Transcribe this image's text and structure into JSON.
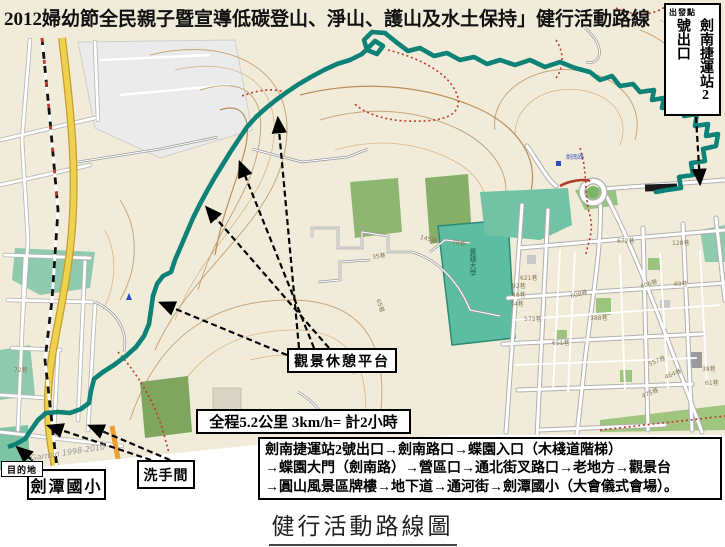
{
  "page": {
    "top_title": "2012婦幼節全民親子暨宣導低碳登山、淨山、護山及水土保持」健行活動路線",
    "bottom_title": "健行活動路線圖"
  },
  "start_box": {
    "tag": "出發點",
    "exit": "2號出口",
    "station": "劍南捷運站"
  },
  "annotations": {
    "platform": "觀景休憩平台",
    "distance": "全程5.2公里  3km/h= 計2小時",
    "school": "劍潭國小",
    "restroom": "洗手間",
    "destination": "目的地",
    "route_steps": [
      "劍南捷運站2號出口→劍南路口→蝶園入口（木棧道階梯）",
      "→蝶園大門（劍南路）→營區口→通北街叉路口→老地方→觀景台",
      "→圓山風景區牌樓→地下道→通河街→劍潭國小（大會儀式會場）。"
    ]
  },
  "map": {
    "watermark": "Garmin 1998-2010",
    "campus_label": "實踐大學",
    "road_label": "劍南路",
    "street_labels": [
      "672巷",
      "128巷",
      "606巷",
      "69巷",
      "588巷",
      "608巷",
      "651巷",
      "573巷",
      "621巷",
      "92巷",
      "46巷",
      "54巷",
      "557巷",
      "464巷",
      "475巷",
      "38巷",
      "61巷",
      "72巷",
      "145巷",
      "78巷",
      "35巷",
      "65巷"
    ]
  },
  "colors": {
    "route_teal": "#0f8278",
    "trail_red": "#c0392b",
    "road_yellow": "#ecd24f",
    "park_teal": "#8fc9ae",
    "campus_teal": "#5dbda0",
    "forest_green": "#8fb573",
    "contour_tan": "#c9a57c",
    "map_cream": "#f0ecd9"
  }
}
